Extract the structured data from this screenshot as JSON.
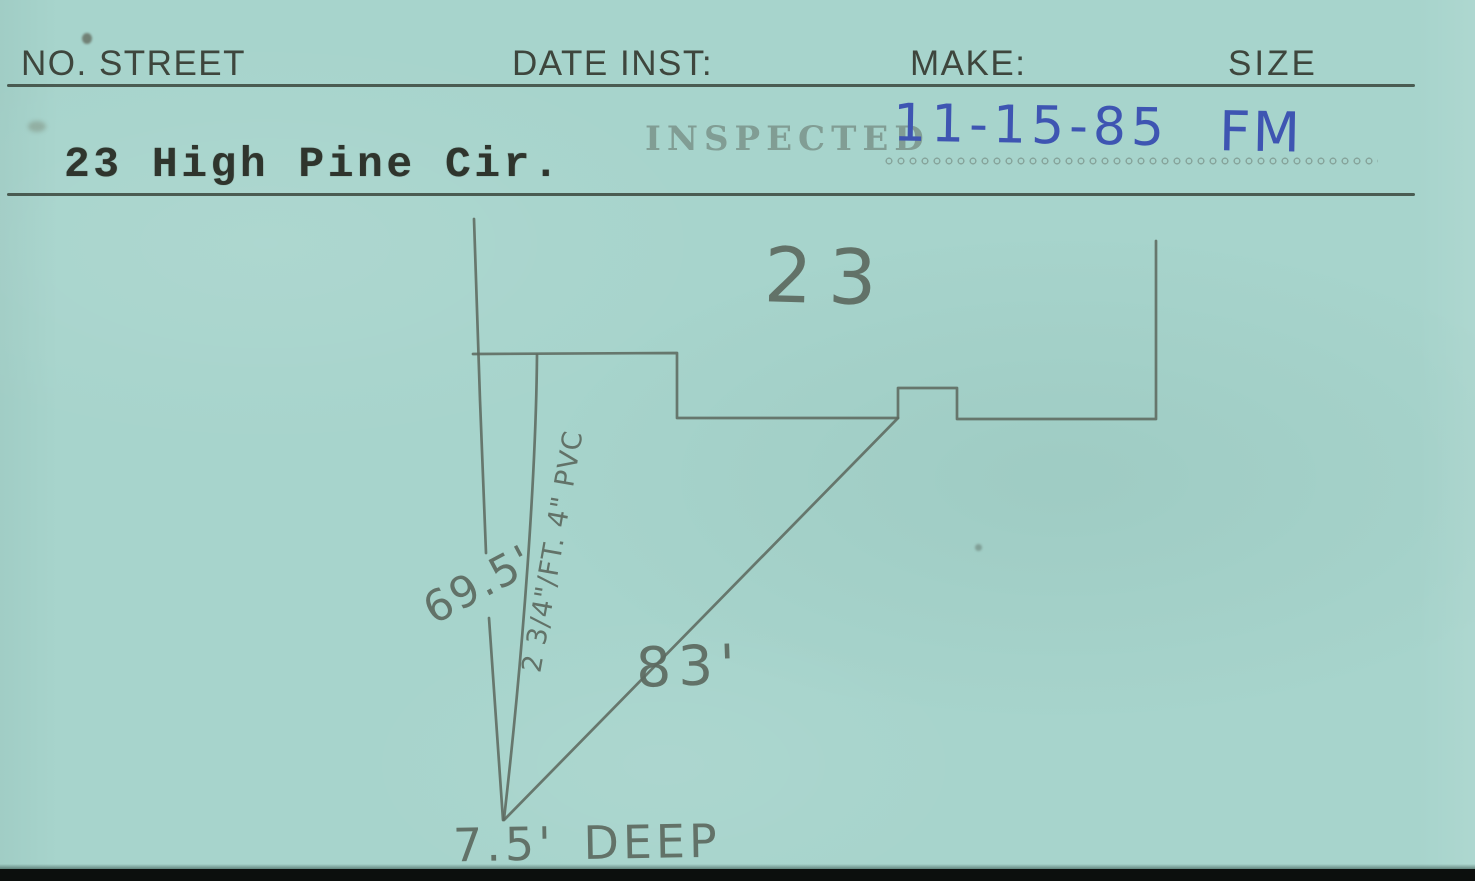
{
  "header": {
    "no_street": "NO. STREET",
    "date_inst": "DATE INST:",
    "make": "MAKE:",
    "size": "SIZE"
  },
  "record": {
    "address": "23 High Pine Cir.",
    "inspected_stamp": "INSPECTED",
    "inspected_date": "11-15-85",
    "inspector_initials": "FM"
  },
  "diagram": {
    "house_number": "23",
    "street_line_length": "69.5'",
    "pipe_spec": "2 3/4\"/FT. 4\" PVC",
    "lateral_length": "83'",
    "depth": "7.5' DEEP"
  },
  "colors": {
    "card_bg": "#a7d4cc",
    "pencil": "#5d6a60",
    "header_ink": "#3e463d",
    "typewriter_ink": "#2f352d",
    "stamp_ink": "#7b948b",
    "pen_blue": "#3e55b2",
    "edge_black": "#0c0f0d"
  }
}
